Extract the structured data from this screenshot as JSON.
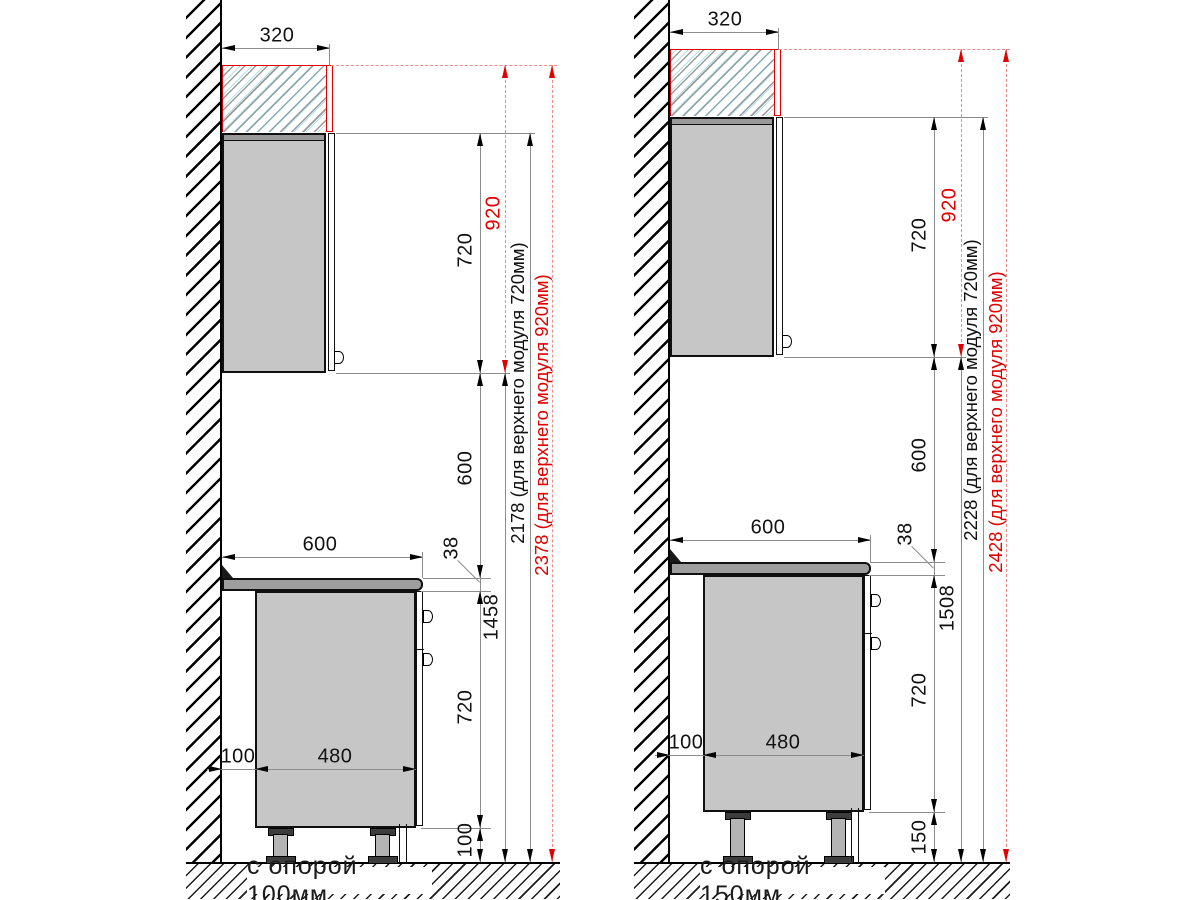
{
  "drawing": {
    "type": "kitchen cabinet installation elevation, side view, two variants",
    "units": "mm",
    "colors": {
      "accent_red": "#e00000",
      "line_black": "#000000",
      "cabinet_fill": "#c6c6c6",
      "countertop_fill": "#9e9e9e"
    }
  },
  "panels": [
    {
      "caption": "с опорой 100мм",
      "dims": {
        "top_depth": "320",
        "upper_module_920": "920",
        "upper_module_720": "720",
        "splash_gap": "600",
        "countertop_depth": "600",
        "countertop_thickness": "38",
        "worktop_level": "1458",
        "base_module": "720",
        "support": "100",
        "wall_gap": "100",
        "base_body_depth": "480",
        "total_h720": "2178  (для верхнего модуля 720мм)",
        "total_h920": "2378 (для верхнего модуля 920мм)"
      }
    },
    {
      "caption": "с опорой 150мм",
      "dims": {
        "top_depth": "320",
        "upper_module_920": "920",
        "upper_module_720": "720",
        "splash_gap": "600",
        "countertop_depth": "600",
        "countertop_thickness": "38",
        "worktop_level": "1508",
        "base_module": "720",
        "support": "150",
        "wall_gap": "100",
        "base_body_depth": "480",
        "total_h720": "2228 (для верхнего модуля 720мм)",
        "total_h920": "2428 (для верхнего модуля 920мм)"
      }
    }
  ]
}
